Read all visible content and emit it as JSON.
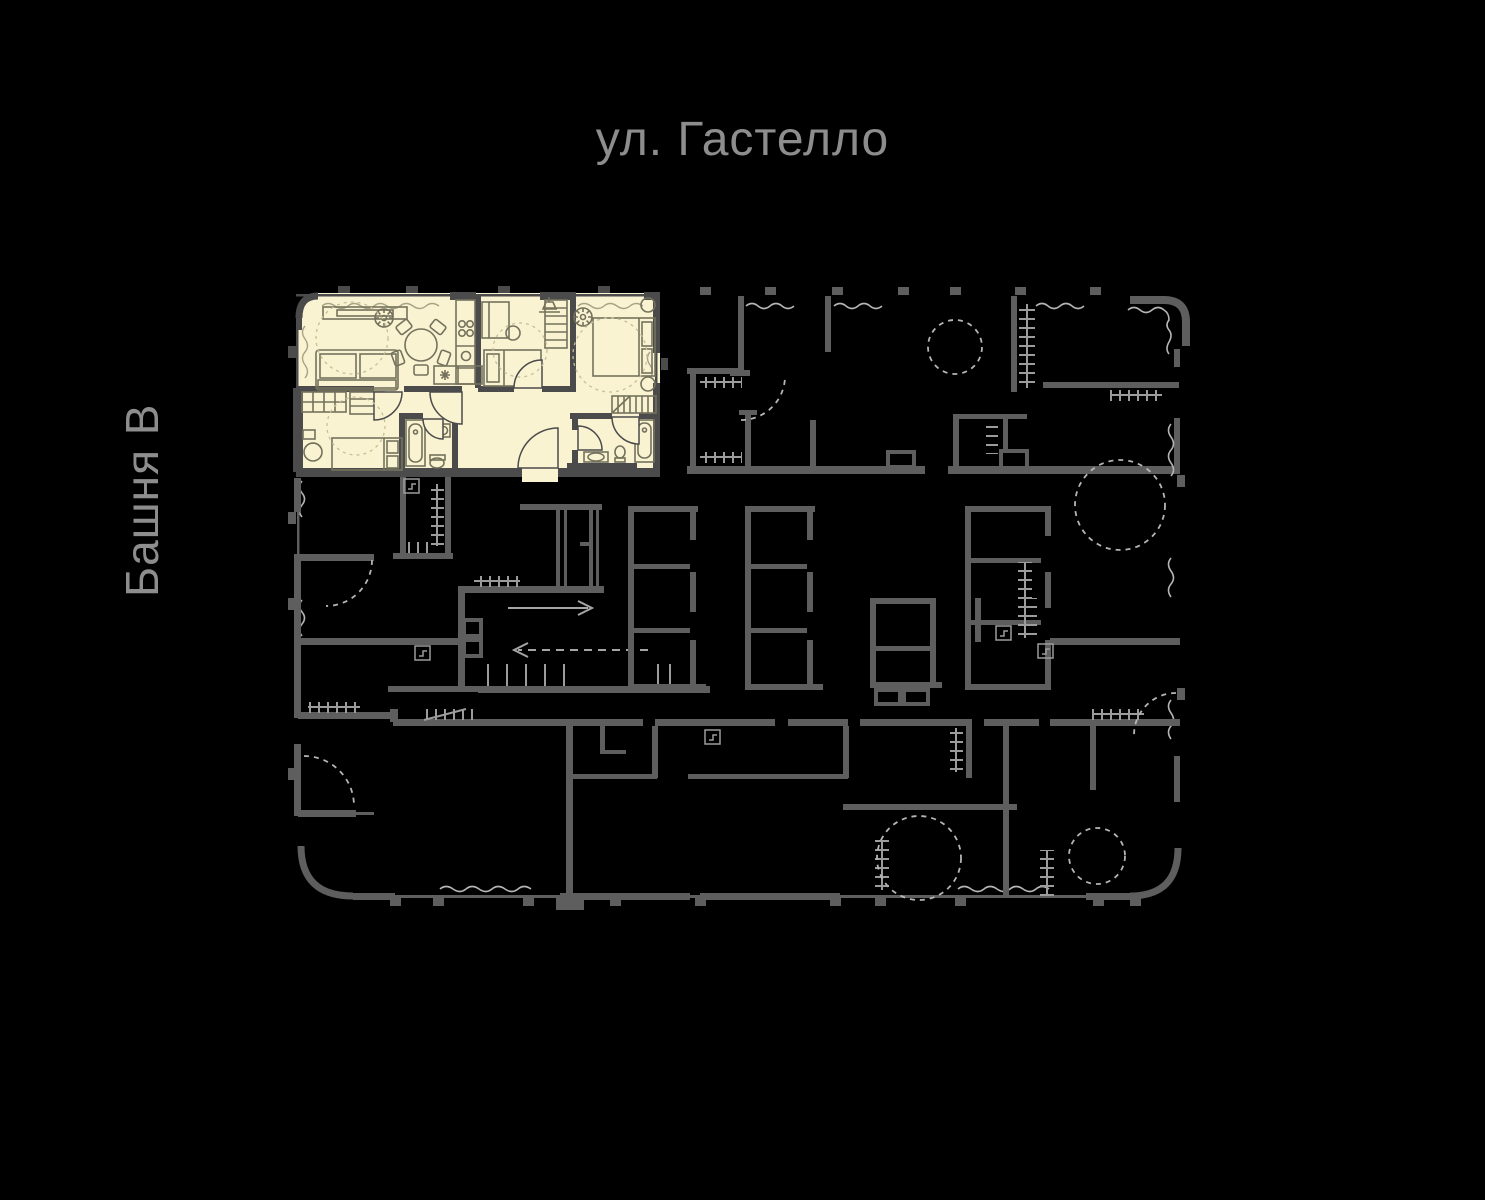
{
  "labels": {
    "street": "ул. Гастелло",
    "tower": "Башня В"
  },
  "colors": {
    "background": "#000000",
    "label_text": "#8d8d8d",
    "plan_wall": "#5e5e5e",
    "plan_hatch": "#9c9c9c",
    "plan_dashed": "#b5b5b5",
    "plan_window": "#b5b5b5",
    "unit_fill": "#f9f3d2",
    "unit_wall": "#4b4b4b",
    "furniture": "#74725c",
    "unit_zone": "#c6bf9a",
    "unit_window": "#a8a387",
    "core_arrow": "#a5a5a5"
  },
  "floor_plan": {
    "highlighted_unit": {
      "selected": true
    }
  }
}
